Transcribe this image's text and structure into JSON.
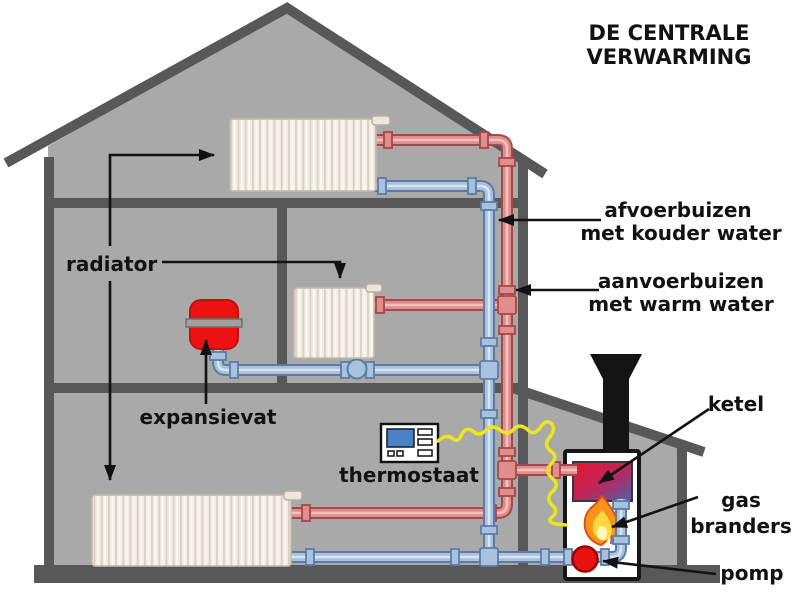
{
  "title": {
    "line1": "DE CENTRALE",
    "line2": "VERWARMING"
  },
  "labels": {
    "radiator": "radiator",
    "expansievat": "expansievat",
    "thermostaat": "thermostaat",
    "return_pipes_line1": "afvoerbuizen",
    "return_pipes_line2": "met kouder water",
    "supply_pipes_line1": "aanvoerbuizen",
    "supply_pipes_line2": "met warm water",
    "ketel": "ketel",
    "gas_branders_line1": "gas",
    "gas_branders_line2": "branders",
    "pomp": "pomp"
  },
  "colors": {
    "house_fill": "#a9a9a9",
    "structure_dark": "#58585a",
    "supply_pipe_red": "#e28d8d",
    "supply_pipe_border": "#a04a4a",
    "return_pipe_blue": "#aac1dd",
    "return_pipe_border": "#5c7ca6",
    "expansion_vessel_red": "#ee1111",
    "pump_red": "#e81212",
    "wire_yellow": "#ece61a",
    "thermostat_screen_blue": "#4a80c4",
    "flame_orange": "#f7941d",
    "flame_yellow": "#ffd83d",
    "chimney_black": "#141414",
    "text_black": "#121212"
  }
}
